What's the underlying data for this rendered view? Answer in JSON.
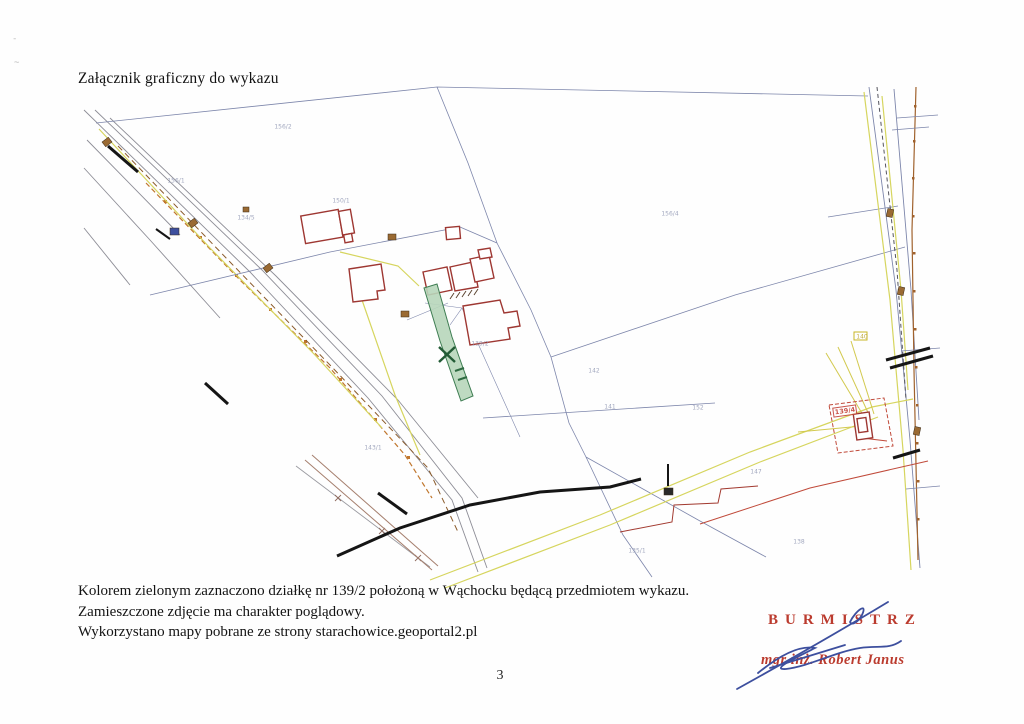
{
  "page": {
    "title": "Załącznik graficzny do wykazu",
    "captions": [
      "Kolorem zielonym zaznaczono działkę nr 139/2 położoną w Wąchocku będącą przedmiotem wykazu.",
      "Zamieszczone zdjęcie ma charakter poglądowy.",
      "Wykorzystano mapy pobrane ze strony starachowice.geoportal2.pl"
    ],
    "page_number": "3"
  },
  "stamp": {
    "role": "BURMISTRZ",
    "name": "mgr inż. Robert Janus",
    "ink_color": "#bb3b2e",
    "signature_color": "#3d4f9e"
  },
  "map": {
    "highlighted_parcel": "139/2",
    "marker": {
      "symbol": "X",
      "x": 447,
      "y": 355
    },
    "colors": {
      "parcel_line": "#7d86ab",
      "road_gray": "#8d8d96",
      "building_red": "#9e3732",
      "highlight_fill": "#b7d6ba",
      "highlight_stroke": "#3e7d52",
      "utility_orange": "#c0772e",
      "utility_brown": "#8a5a2a",
      "road_yellow": "#d6d55e",
      "red_line": "#c04a3a",
      "black_structure": "#151515"
    },
    "labels": [
      {
        "t": "156/2",
        "x": 283,
        "y": 127
      },
      {
        "t": "156/1",
        "x": 176,
        "y": 181
      },
      {
        "t": "150/1",
        "x": 341,
        "y": 201
      },
      {
        "t": "134/5",
        "x": 246,
        "y": 218
      },
      {
        "t": "156/4",
        "x": 670,
        "y": 214
      },
      {
        "t": "139/2",
        "x": 480,
        "y": 344
      },
      {
        "t": "143/1",
        "x": 373,
        "y": 448
      },
      {
        "t": "142",
        "x": 594,
        "y": 371
      },
      {
        "t": "141",
        "x": 610,
        "y": 407
      },
      {
        "t": "152",
        "x": 698,
        "y": 408
      },
      {
        "t": "147",
        "x": 756,
        "y": 472
      },
      {
        "t": "138",
        "x": 799,
        "y": 542
      },
      {
        "t": "135/1",
        "x": 637,
        "y": 551
      },
      {
        "t": "140",
        "x": 862,
        "y": 337,
        "c": "#b8a020"
      },
      {
        "t": "139/4",
        "x": 845,
        "y": 411,
        "c": "#c0392f",
        "box": true
      }
    ]
  }
}
